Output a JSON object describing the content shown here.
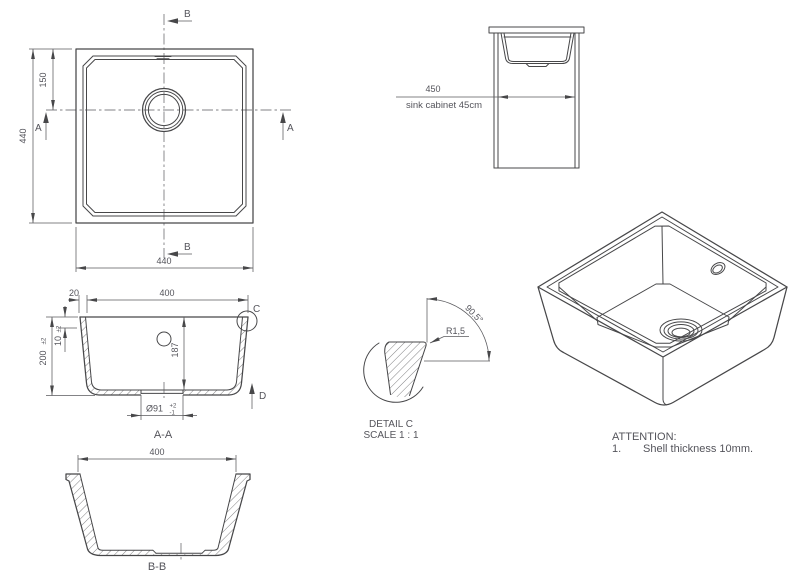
{
  "plan_view": {
    "dim_left": "440",
    "dim_top_offset": "150",
    "dim_bottom": "440",
    "marker_b_top": "B",
    "marker_b_bottom": "B",
    "marker_a_left": "A",
    "marker_a_right": "A"
  },
  "cabinet_view": {
    "dim": "450",
    "label": "sink cabinet 45cm"
  },
  "section_aa": {
    "dim_rim": "20",
    "dim_width": "400",
    "dim_shell": "10",
    "dim_shell_tol": "±2",
    "dim_height": "200",
    "dim_height_tol": "±2",
    "dim_depth": "187",
    "dim_drain": "Ø91",
    "dim_drain_tol_plus": "+2",
    "dim_drain_tol_minus": "-1",
    "detail_balloon": "C",
    "direction_arrow": "D",
    "title": "A-A"
  },
  "detail_c": {
    "radius": "R1,5",
    "angle": "90.5°",
    "title": "DETAIL C",
    "scale": "SCALE 1 : 1"
  },
  "section_bb": {
    "dim_width": "400",
    "title": "B-B"
  },
  "attention": {
    "heading": "ATTENTION:",
    "item_number": "1.",
    "item_text": "Shell thickness 10mm."
  }
}
